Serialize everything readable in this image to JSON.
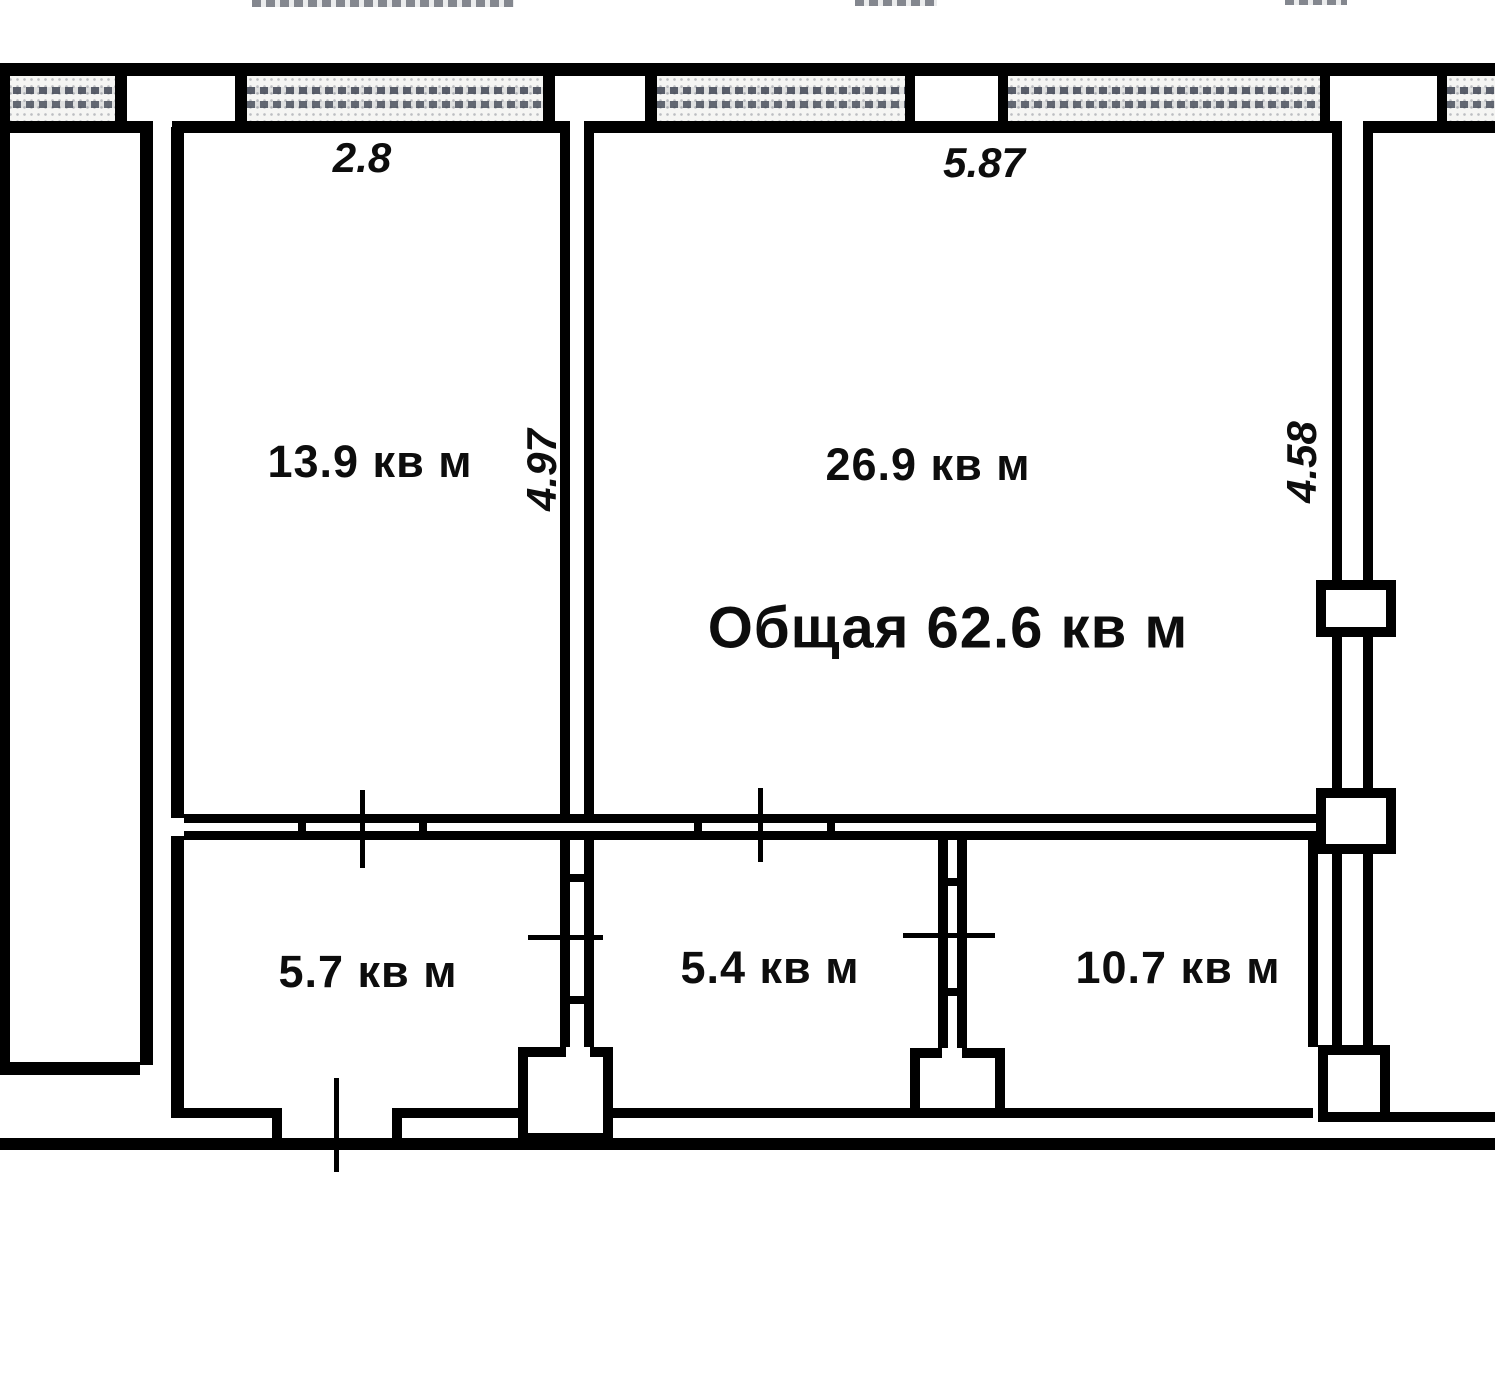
{
  "floorplan": {
    "type": "apartment-floor-plan",
    "unit": "кв м",
    "total_area": {
      "label": "Общая 62.6 кв м",
      "value": 62.6
    },
    "rooms": [
      {
        "id": "room-13-9",
        "area_label": "13.9 кв м",
        "value": 13.9
      },
      {
        "id": "room-26-9",
        "area_label": "26.9 кв м",
        "value": 26.9
      },
      {
        "id": "room-5-7",
        "area_label": "5.7 кв м",
        "value": 5.7
      },
      {
        "id": "room-5-4",
        "area_label": "5.4 кв м",
        "value": 5.4
      },
      {
        "id": "room-10-7",
        "area_label": "10.7 кв м",
        "value": 10.7
      }
    ],
    "dimensions": [
      {
        "id": "dim-width-left",
        "label": "2.8",
        "orientation": "horizontal"
      },
      {
        "id": "dim-width-right",
        "label": "5.87",
        "orientation": "horizontal"
      },
      {
        "id": "dim-height-left",
        "label": "4.97",
        "orientation": "vertical"
      },
      {
        "id": "dim-height-right",
        "label": "4.58",
        "orientation": "vertical"
      }
    ],
    "colors": {
      "wall": "#000000",
      "hatch": "#5f6470",
      "paper": "#ffffff",
      "text": "#0d0d0d"
    }
  }
}
